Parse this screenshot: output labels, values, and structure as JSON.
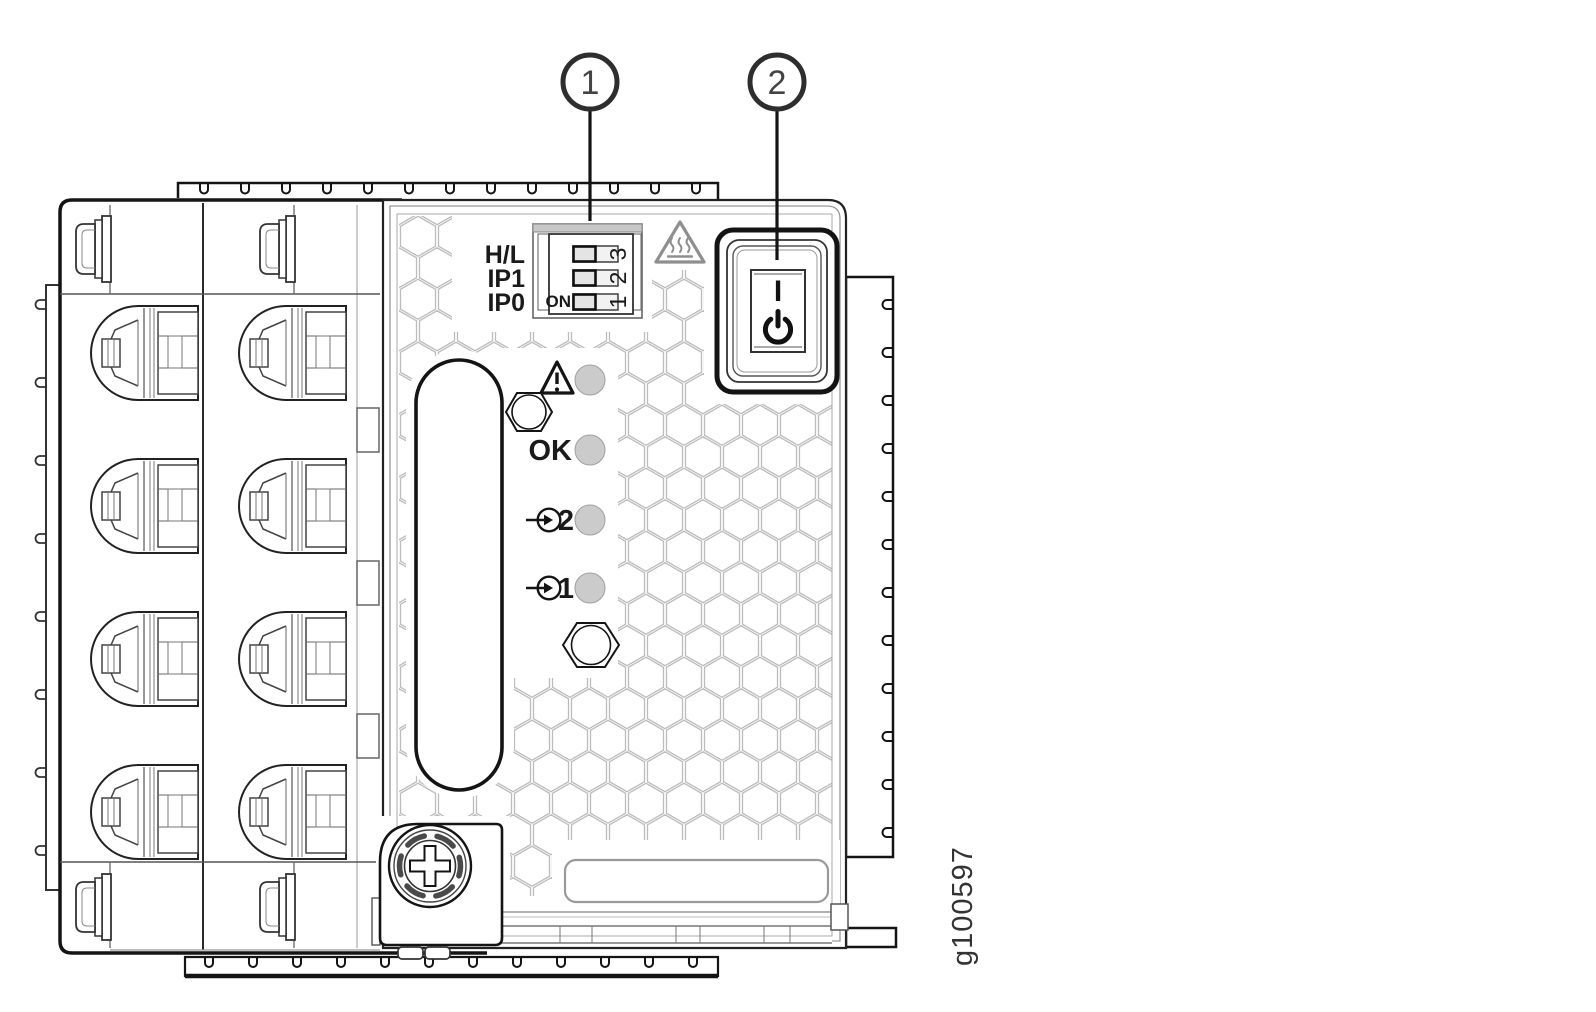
{
  "figure": {
    "id": "g100597"
  },
  "callouts": [
    {
      "number": "1",
      "target": "dip-switch-block"
    },
    {
      "number": "2",
      "target": "power-button"
    }
  ],
  "dip_switch": {
    "row_labels": [
      "H/L",
      "IP1",
      "IP0"
    ],
    "on_label": "ON",
    "position_labels": [
      "3",
      "2",
      "1"
    ]
  },
  "indicators": [
    {
      "icon": "warning-triangle-icon",
      "label": ""
    },
    {
      "icon": "",
      "label": "OK"
    },
    {
      "icon": "input-arrow-icon",
      "label": "2"
    },
    {
      "icon": "input-arrow-icon",
      "label": "1"
    }
  ],
  "power_button": {
    "on_label": "I",
    "standby_icon": "power-standby-icon"
  },
  "icons": {
    "hot_surface": "hot-surface-triangle-icon",
    "thumbscrew": "captive-thumbscrew",
    "handle": "pull-handle"
  },
  "colors": {
    "line": "#141414",
    "mid_gray": "#555555",
    "icon_gray": "#8f8f8f",
    "led_fill": "#cbcbcb",
    "hex_pattern": "#bcbcbc",
    "background": "#ffffff"
  }
}
